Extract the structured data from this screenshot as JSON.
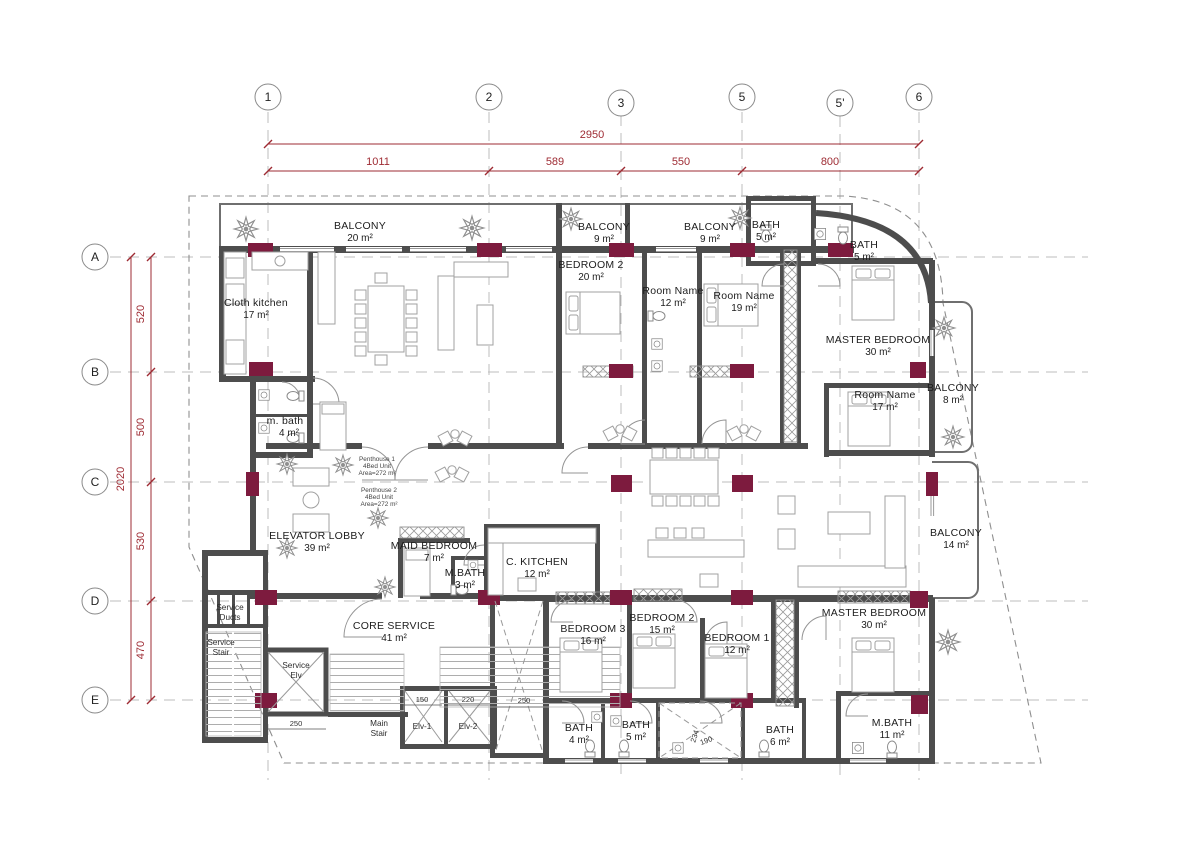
{
  "grid": {
    "columns": [
      "1",
      "2",
      "3",
      "5",
      "5'",
      "6"
    ],
    "rows": [
      "A",
      "B",
      "C",
      "D",
      "E"
    ]
  },
  "dims": {
    "top_total": "2950",
    "top_segments": [
      "1011",
      "589",
      "550",
      "800"
    ],
    "left_total": "2020",
    "left_segments": [
      "520",
      "500",
      "530",
      "470"
    ],
    "details": [
      "250",
      "150",
      "220",
      "250",
      "234",
      "190"
    ]
  },
  "rooms": [
    {
      "name": "BALCONY",
      "area": "20 m²"
    },
    {
      "name": "Cloth kitchen",
      "area": "17 m²"
    },
    {
      "name": "BALCONY",
      "area": "9 m²"
    },
    {
      "name": "BALCONY",
      "area": "9 m²"
    },
    {
      "name": "BATH",
      "area": "5 m²"
    },
    {
      "name": "BATH",
      "area": "5 m²"
    },
    {
      "name": "BEDROOM 2",
      "area": "20 m²"
    },
    {
      "name": "Room Name",
      "area": "12 m²"
    },
    {
      "name": "Room Name",
      "area": "19 m²"
    },
    {
      "name": "MASTER BEDROOM",
      "area": "30 m²"
    },
    {
      "name": "Room Name",
      "area": "17 m²"
    },
    {
      "name": "BALCONY",
      "area": "8 m²"
    },
    {
      "name": "m. bath",
      "area": "4 m²"
    },
    {
      "name": "ELEVATOR LOBBY",
      "area": "39 m²"
    },
    {
      "name": "MAID BEDROOM",
      "area": "7 m²"
    },
    {
      "name": "M.BATH",
      "area": "3 m²"
    },
    {
      "name": "C. KITCHEN",
      "area": "12 m²"
    },
    {
      "name": "BALCONY",
      "area": "14 m²"
    },
    {
      "name": "CORE SERVICE",
      "area": "41 m²"
    },
    {
      "name": "BEDROOM 3",
      "area": "16 m²"
    },
    {
      "name": "BEDROOM 2",
      "area": "15 m²"
    },
    {
      "name": "BEDROOM 1",
      "area": "12 m²"
    },
    {
      "name": "MASTER BEDROOM",
      "area": "30 m²"
    },
    {
      "name": "BATH",
      "area": "4 m²"
    },
    {
      "name": "BATH",
      "area": "5 m²"
    },
    {
      "name": "BATH",
      "area": "6 m²"
    },
    {
      "name": "M.BATH",
      "area": "11 m²"
    }
  ],
  "units": {
    "penthouse1": {
      "line1": "Penthouse 1",
      "line2": "4Bed Unit",
      "line3": "Area=272 m²"
    },
    "penthouse2": {
      "line1": "Penthouse 2",
      "line2": "4Bed Unit",
      "line3": "Area=272 m²"
    }
  },
  "core": {
    "service_ducts": [
      "Service",
      "Ducts"
    ],
    "service_stair": [
      "Service",
      "Stair"
    ],
    "service_elv": [
      "Service",
      "Elv"
    ],
    "main_stair": [
      "Main",
      "Stair"
    ],
    "elv1": "Elv-1",
    "elv2": "Elv-2"
  },
  "colors": {
    "dimension": "#9e2b33",
    "column": "#7d1b3e",
    "wall": "#4d4d4d"
  }
}
